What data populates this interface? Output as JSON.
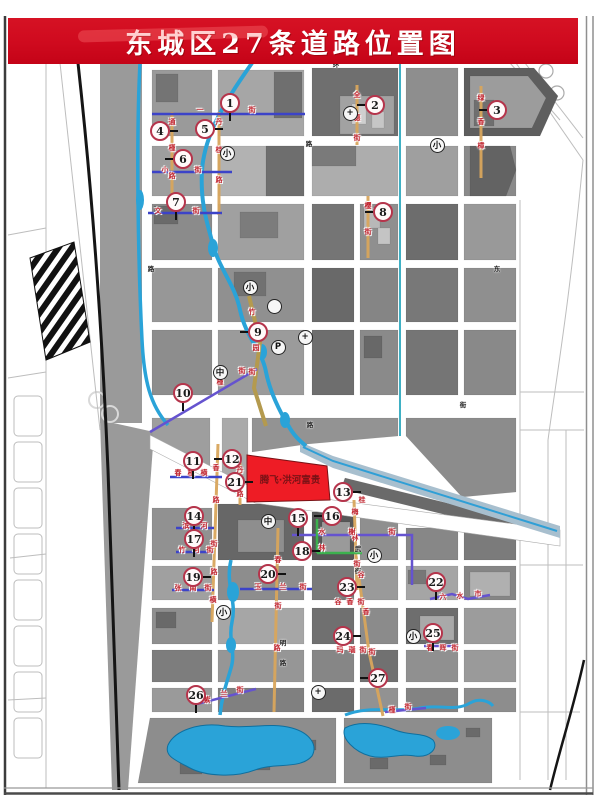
{
  "title": "东城区27条道路位置图",
  "development_label": "腾飞·洪河富贵",
  "palette": {
    "banner_red": "#cf0a1e",
    "parcel_red": "#ee1c25",
    "parcel_text": "#7a1216",
    "water_blue": "#2aa3d8",
    "road_orange": "#d8a55c",
    "road_blue": "#3c43c8",
    "road_purple": "#6553cf",
    "road_green": "#3cb14e",
    "marker_ring": "#b5344b"
  },
  "markers": [
    {
      "n": "1",
      "x": 230,
      "y": 103,
      "d": "down"
    },
    {
      "n": "2",
      "x": 375,
      "y": 105,
      "d": "left"
    },
    {
      "n": "3",
      "x": 497,
      "y": 110,
      "d": "left"
    },
    {
      "n": "4",
      "x": 160,
      "y": 131,
      "d": "right"
    },
    {
      "n": "5",
      "x": 205,
      "y": 129,
      "d": "right"
    },
    {
      "n": "6",
      "x": 183,
      "y": 159,
      "d": "left"
    },
    {
      "n": "7",
      "x": 176,
      "y": 202,
      "d": "down"
    },
    {
      "n": "8",
      "x": 383,
      "y": 212,
      "d": "left"
    },
    {
      "n": "9",
      "x": 258,
      "y": 332,
      "d": "left"
    },
    {
      "n": "10",
      "x": 183,
      "y": 393,
      "d": "down"
    },
    {
      "n": "11",
      "x": 193,
      "y": 461,
      "d": "down"
    },
    {
      "n": "12",
      "x": 232,
      "y": 459,
      "d": "left"
    },
    {
      "n": "13",
      "x": 343,
      "y": 492,
      "d": "right"
    },
    {
      "n": "14",
      "x": 194,
      "y": 516,
      "d": "down"
    },
    {
      "n": "15",
      "x": 298,
      "y": 518,
      "d": "down"
    },
    {
      "n": "16",
      "x": 332,
      "y": 516,
      "d": "left"
    },
    {
      "n": "17",
      "x": 194,
      "y": 539,
      "d": "down"
    },
    {
      "n": "18",
      "x": 302,
      "y": 551,
      "d": "right"
    },
    {
      "n": "19",
      "x": 193,
      "y": 577,
      "d": "right"
    },
    {
      "n": "20",
      "x": 268,
      "y": 574,
      "d": "right"
    },
    {
      "n": "21",
      "x": 235,
      "y": 482,
      "d": "right"
    },
    {
      "n": "22",
      "x": 436,
      "y": 582,
      "d": "down"
    },
    {
      "n": "23",
      "x": 347,
      "y": 587,
      "d": "right"
    },
    {
      "n": "24",
      "x": 343,
      "y": 636,
      "d": "right"
    },
    {
      "n": "25",
      "x": 433,
      "y": 633,
      "d": "down"
    },
    {
      "n": "26",
      "x": 196,
      "y": 695,
      "d": "down"
    },
    {
      "n": "27",
      "x": 378,
      "y": 678,
      "d": "left"
    }
  ],
  "symbols": [
    {
      "t": "+",
      "x": 350,
      "y": 113,
      "name": "hospital-icon"
    },
    {
      "t": "",
      "x": 274,
      "y": 306,
      "name": "circle-icon"
    },
    {
      "t": "+",
      "x": 305,
      "y": 337,
      "name": "hospital-icon"
    },
    {
      "t": "P",
      "x": 278,
      "y": 347,
      "name": "parking-icon"
    },
    {
      "t": "中",
      "x": 220,
      "y": 372,
      "name": "middle-school-icon"
    },
    {
      "t": "小",
      "x": 227,
      "y": 153,
      "name": "primary-school-icon"
    },
    {
      "t": "小",
      "x": 437,
      "y": 145,
      "name": "primary-school-icon"
    },
    {
      "t": "小",
      "x": 250,
      "y": 287,
      "name": "primary-school-icon"
    },
    {
      "t": "中",
      "x": 268,
      "y": 521,
      "name": "middle-school-icon"
    },
    {
      "t": "小",
      "x": 374,
      "y": 555,
      "name": "primary-school-icon"
    },
    {
      "t": "小",
      "x": 223,
      "y": 612,
      "name": "primary-school-icon"
    },
    {
      "t": "小",
      "x": 413,
      "y": 636,
      "name": "primary-school-icon"
    },
    {
      "t": "+",
      "x": 318,
      "y": 692,
      "name": "hospital-icon"
    }
  ],
  "road_marks": [
    {
      "x": 172,
      "y": 122,
      "t": "通"
    },
    {
      "x": 172,
      "y": 148,
      "t": "槿"
    },
    {
      "x": 172,
      "y": 176,
      "t": "路"
    },
    {
      "x": 219,
      "y": 122,
      "t": "丹"
    },
    {
      "x": 219,
      "y": 150,
      "t": "桂"
    },
    {
      "x": 219,
      "y": 180,
      "t": "路"
    },
    {
      "x": 200,
      "y": 110,
      "t": "一"
    },
    {
      "x": 252,
      "y": 110,
      "t": "街"
    },
    {
      "x": 165,
      "y": 170,
      "t": "小"
    },
    {
      "x": 198,
      "y": 170,
      "t": "街"
    },
    {
      "x": 158,
      "y": 211,
      "t": "文"
    },
    {
      "x": 196,
      "y": 211,
      "t": "街"
    },
    {
      "x": 357,
      "y": 95,
      "t": "全"
    },
    {
      "x": 357,
      "y": 118,
      "t": "德"
    },
    {
      "x": 357,
      "y": 138,
      "t": "街"
    },
    {
      "x": 481,
      "y": 98,
      "t": "绿"
    },
    {
      "x": 481,
      "y": 122,
      "t": "香"
    },
    {
      "x": 481,
      "y": 146,
      "t": "樟"
    },
    {
      "x": 368,
      "y": 206,
      "t": "樱"
    },
    {
      "x": 368,
      "y": 232,
      "t": "街"
    },
    {
      "x": 252,
      "y": 312,
      "t": "竹"
    },
    {
      "x": 256,
      "y": 348,
      "t": "园"
    },
    {
      "x": 252,
      "y": 372,
      "t": "街"
    },
    {
      "x": 220,
      "y": 382,
      "t": "槿"
    },
    {
      "x": 242,
      "y": 371,
      "t": "街"
    },
    {
      "x": 178,
      "y": 473,
      "t": "春"
    },
    {
      "x": 191,
      "y": 473,
      "t": "槿"
    },
    {
      "x": 204,
      "y": 473,
      "t": "横"
    },
    {
      "x": 216,
      "y": 468,
      "t": "香"
    },
    {
      "x": 216,
      "y": 500,
      "t": "路"
    },
    {
      "x": 214,
      "y": 544,
      "t": "街"
    },
    {
      "x": 214,
      "y": 572,
      "t": "路"
    },
    {
      "x": 213,
      "y": 600,
      "t": "横"
    },
    {
      "x": 240,
      "y": 470,
      "t": "丹"
    },
    {
      "x": 240,
      "y": 494,
      "t": "路"
    },
    {
      "x": 355,
      "y": 512,
      "t": "梅"
    },
    {
      "x": 355,
      "y": 538,
      "t": "林"
    },
    {
      "x": 357,
      "y": 564,
      "t": "街"
    },
    {
      "x": 322,
      "y": 532,
      "t": "水"
    },
    {
      "x": 352,
      "y": 532,
      "t": "榭"
    },
    {
      "x": 392,
      "y": 532,
      "t": "街"
    },
    {
      "x": 322,
      "y": 548,
      "t": "林"
    },
    {
      "x": 186,
      "y": 526,
      "t": "滨"
    },
    {
      "x": 204,
      "y": 526,
      "t": "河"
    },
    {
      "x": 182,
      "y": 550,
      "t": "竹"
    },
    {
      "x": 196,
      "y": 550,
      "t": "河"
    },
    {
      "x": 210,
      "y": 550,
      "t": "街"
    },
    {
      "x": 178,
      "y": 588,
      "t": "张"
    },
    {
      "x": 193,
      "y": 588,
      "t": "南"
    },
    {
      "x": 208,
      "y": 588,
      "t": "街"
    },
    {
      "x": 258,
      "y": 587,
      "t": "玉"
    },
    {
      "x": 283,
      "y": 587,
      "t": "兰"
    },
    {
      "x": 303,
      "y": 587,
      "t": "街"
    },
    {
      "x": 278,
      "y": 560,
      "t": "春"
    },
    {
      "x": 278,
      "y": 606,
      "t": "街"
    },
    {
      "x": 277,
      "y": 648,
      "t": "路"
    },
    {
      "x": 361,
      "y": 575,
      "t": "谷"
    },
    {
      "x": 366,
      "y": 612,
      "t": "香"
    },
    {
      "x": 372,
      "y": 652,
      "t": "街"
    },
    {
      "x": 338,
      "y": 602,
      "t": "谷"
    },
    {
      "x": 350,
      "y": 602,
      "t": "香"
    },
    {
      "x": 361,
      "y": 602,
      "t": "街"
    },
    {
      "x": 340,
      "y": 650,
      "t": "玛"
    },
    {
      "x": 352,
      "y": 650,
      "t": "瑙"
    },
    {
      "x": 363,
      "y": 650,
      "t": "街"
    },
    {
      "x": 443,
      "y": 597,
      "t": "六"
    },
    {
      "x": 460,
      "y": 596,
      "t": "水"
    },
    {
      "x": 478,
      "y": 594,
      "t": "市"
    },
    {
      "x": 430,
      "y": 648,
      "t": "春"
    },
    {
      "x": 443,
      "y": 648,
      "t": "晖"
    },
    {
      "x": 455,
      "y": 648,
      "t": "街"
    },
    {
      "x": 207,
      "y": 700,
      "t": "紫"
    },
    {
      "x": 224,
      "y": 694,
      "t": "兰"
    },
    {
      "x": 240,
      "y": 690,
      "t": "街"
    },
    {
      "x": 392,
      "y": 710,
      "t": "槿"
    },
    {
      "x": 408,
      "y": 707,
      "t": "街"
    },
    {
      "x": 362,
      "y": 500,
      "t": "桂"
    }
  ],
  "black_marks": [
    {
      "x": 309,
      "y": 143,
      "t": "路"
    },
    {
      "x": 151,
      "y": 268,
      "t": "路"
    },
    {
      "x": 358,
      "y": 548,
      "t": "武"
    },
    {
      "x": 358,
      "y": 570,
      "t": "街"
    },
    {
      "x": 283,
      "y": 642,
      "t": "明"
    },
    {
      "x": 283,
      "y": 662,
      "t": "路"
    },
    {
      "x": 497,
      "y": 268,
      "t": "东"
    },
    {
      "x": 310,
      "y": 424,
      "t": "路"
    },
    {
      "x": 463,
      "y": 404,
      "t": "街"
    },
    {
      "x": 336,
      "y": 64,
      "t": "环"
    }
  ]
}
